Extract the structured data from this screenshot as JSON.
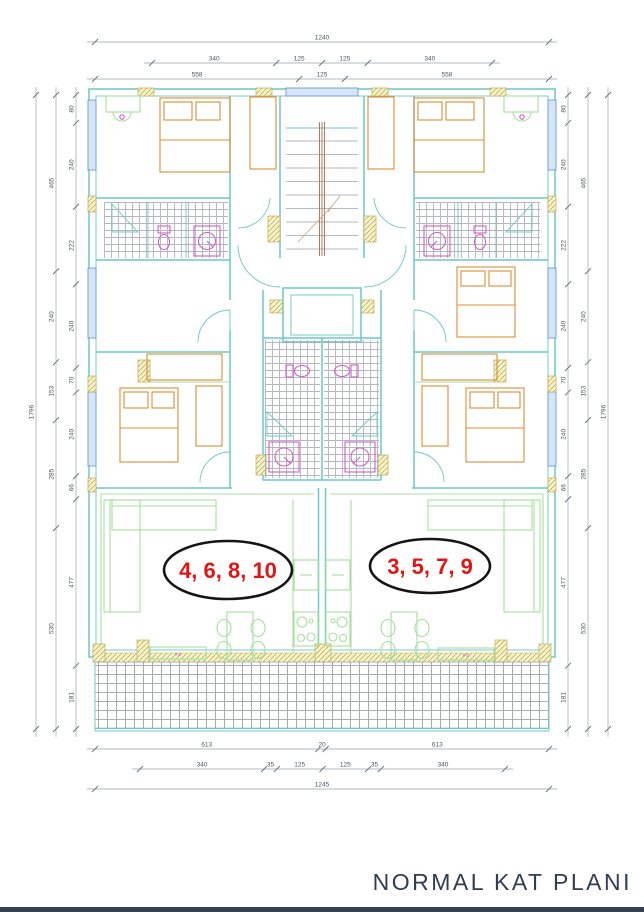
{
  "title": "NORMAL KAT PLANI",
  "units": {
    "left": {
      "label": "4, 6, 8, 10"
    },
    "right": {
      "label": "3, 5, 7, 9"
    }
  },
  "room_labels": {
    "left_area": "m2",
    "right_area": "m2"
  },
  "dimensions": {
    "top": {
      "overall": [
        "1240"
      ],
      "row2": [
        "340",
        "125",
        "125",
        "340"
      ],
      "row3": [
        "558",
        "125",
        "558"
      ]
    },
    "bottom": {
      "row1": [
        "613",
        "20",
        "613"
      ],
      "row2": [
        "340",
        "35",
        "125",
        "125",
        "35",
        "340"
      ],
      "overall": [
        "1245"
      ]
    },
    "left": {
      "outer": [
        "1796"
      ],
      "middle": [
        "465",
        "240",
        "153",
        "285",
        "530"
      ],
      "inner": [
        "80",
        "240",
        "222",
        "240",
        "70",
        "240",
        "66",
        "477",
        "181"
      ]
    },
    "right": {
      "outer": [
        "1796"
      ],
      "middle": [
        "465",
        "240",
        "153",
        "285",
        "530"
      ],
      "inner": [
        "80",
        "240",
        "222",
        "240",
        "70",
        "240",
        "66",
        "477",
        "181"
      ]
    }
  },
  "colors": {
    "wall_teal": "#6cc9c5",
    "partition_green": "#a5df9f",
    "furniture_orange": "#dd8c33",
    "fixture_magenta": "#cf5fc9",
    "window_blue": "#6f97d8",
    "tile_gray": "#9aa0a8",
    "hatch_khaki": "#bdae54",
    "unit_label_red": "#e41414",
    "ellipse_outline_black": "#151515",
    "dimension_gray": "#4a5560",
    "title_navy": "#313d52",
    "footer_bar_navy": "#33404f"
  }
}
